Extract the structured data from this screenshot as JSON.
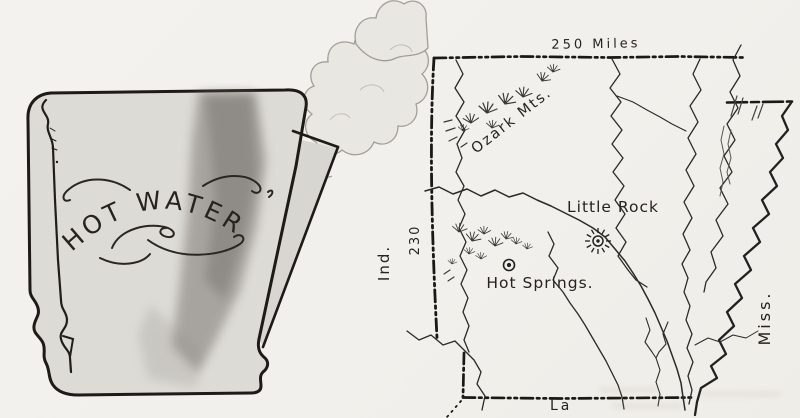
{
  "pitcher": {
    "label": "HOT WATER"
  },
  "map": {
    "top_scale_label": "250 Miles",
    "left_scale_label": "230",
    "west_label": "Ind.",
    "east_label": "Miss.",
    "south_label": "La",
    "mountains_label": "Ozark Mts.",
    "cities": [
      {
        "name": "Little Rock",
        "symbol": "sun-icon"
      },
      {
        "name": "Hot Springs.",
        "symbol": "circle-dot-icon"
      }
    ],
    "colors": {
      "ink": "#26231f",
      "paper": "#f2f0ec"
    }
  }
}
